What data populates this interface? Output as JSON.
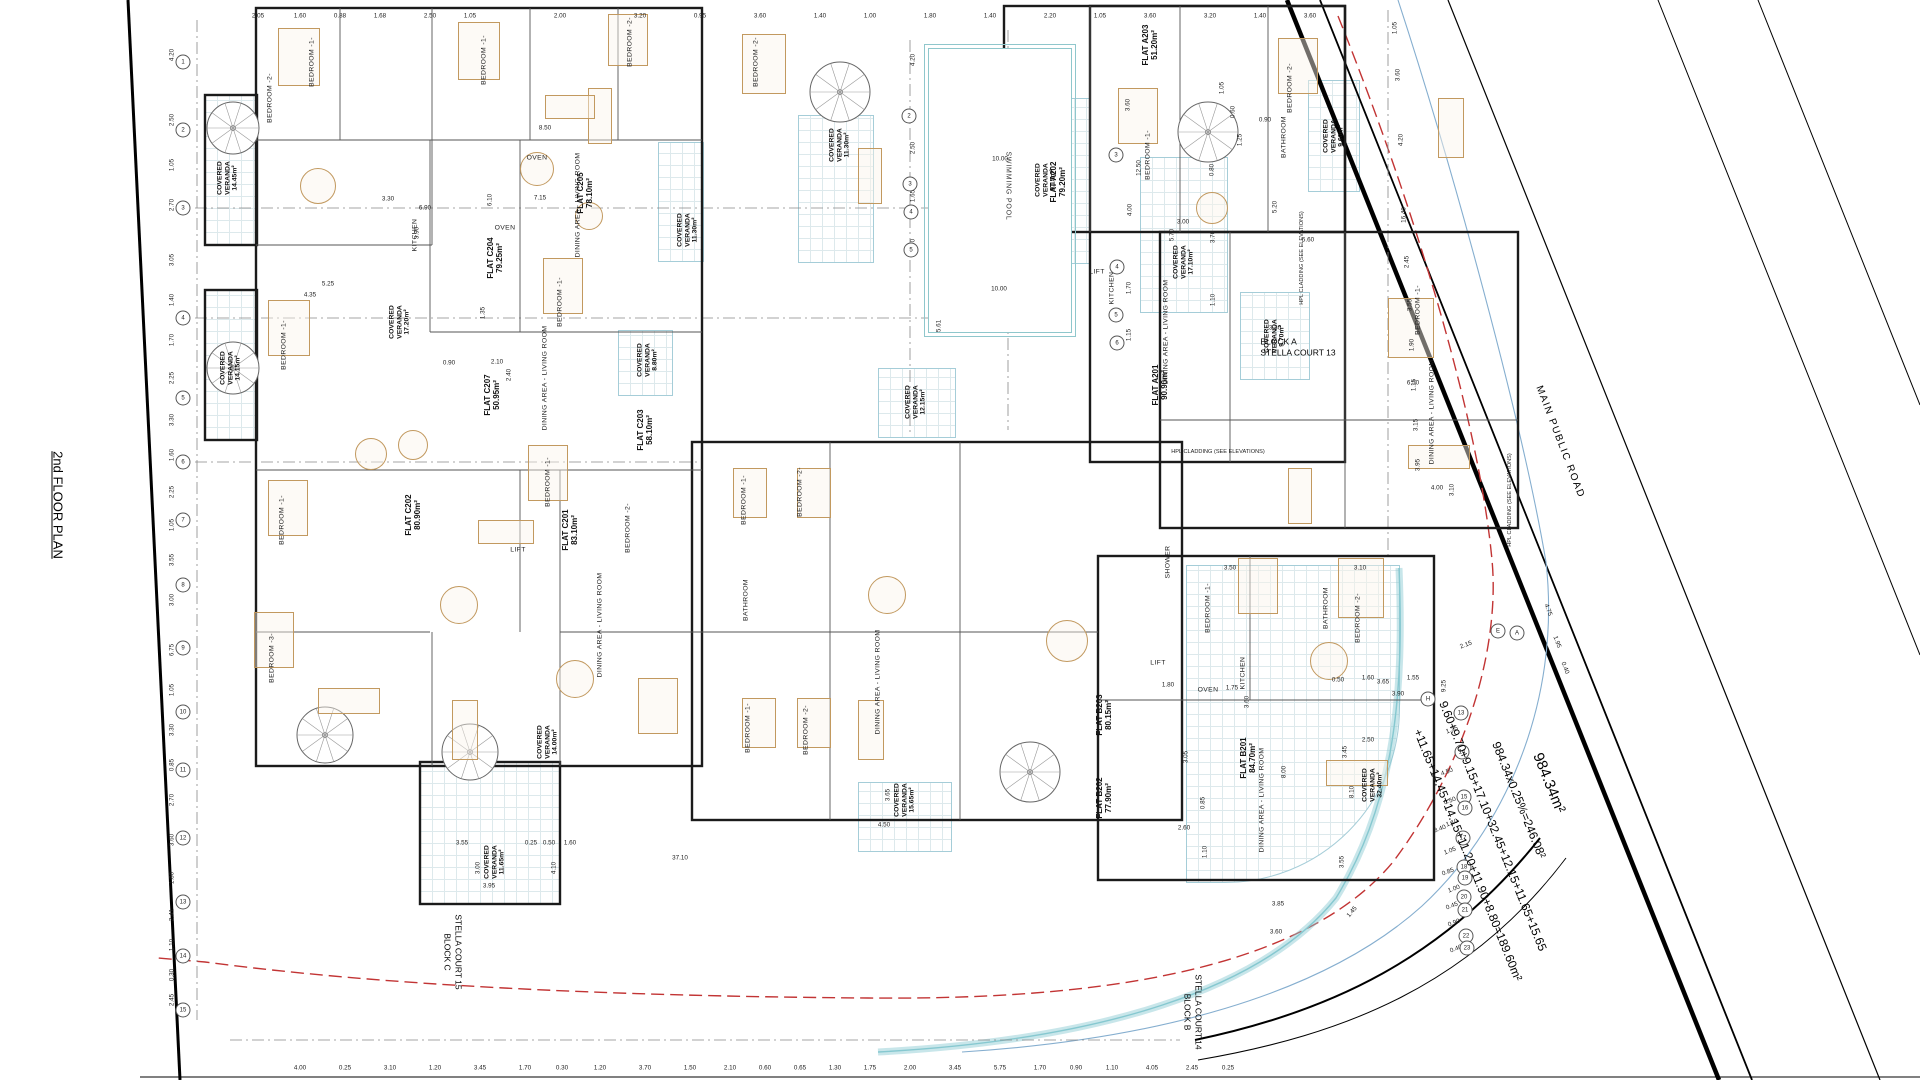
{
  "drawing": {
    "title": "2nd FLOOR PLAN",
    "road": "MAIN PUBLIC ROAD",
    "veranda_title": "COVERED VERANDA",
    "cladding": "HPL CLADDING (SEE ELEVATIONS)",
    "pool": {
      "label": "SWIMMING POOL",
      "w": "10.00",
      "w2": "10.00",
      "side": "5.61"
    },
    "blocks": {
      "a": {
        "name": "BLOCK A",
        "court": "STELLA COURT 13"
      },
      "b": {
        "name": "BLOCK B",
        "court": "STELLA COURT 14"
      },
      "c": {
        "name": "BLOCK C",
        "court": "STELLA COURT 15"
      }
    },
    "calc": {
      "total_area": "984.34m²",
      "coverage": "984.34x0.25%=246.08²",
      "sum_line1": "9.60+9.70+9.15+17.10+32.45+12.15+11.65+15.65",
      "sum_line2": "+11.65+14.45+14.15+11.20+11.90+8.80=189.60m²"
    },
    "colors": {
      "wall": "#1b1b1b",
      "veranda": "#a5cdd8",
      "red_boundary": "#c23434",
      "blue_curb": "#85aecf",
      "teal_band": "#86c8d0",
      "furniture": "#c2995f"
    }
  },
  "flats": [
    [
      "FLAT C205",
      "78.10m²",
      585,
      193
    ],
    [
      "FLAT C204",
      "79.25m²",
      495,
      258
    ],
    [
      "FLAT C207",
      "50.95m²",
      492,
      395
    ],
    [
      "FLAT C203",
      "58.10m²",
      645,
      430
    ],
    [
      "FLAT C202",
      "80.90m²",
      413,
      515
    ],
    [
      "FLAT C201",
      "83.10m²",
      570,
      530
    ],
    [
      "FLAT A203",
      "51.20m²",
      1150,
      45
    ],
    [
      "FLAT A202",
      "79.20m²",
      1058,
      182
    ],
    [
      "FLAT A201",
      "90.90m²",
      1160,
      385
    ],
    [
      "FLAT B203",
      "80.15m²",
      1104,
      715
    ],
    [
      "FLAT B202",
      "77.90m²",
      1104,
      798
    ],
    [
      "FLAT B201",
      "84.70m²",
      1248,
      758
    ]
  ],
  "verandas": [
    [
      "14.45m²",
      228,
      178
    ],
    [
      "17.20m²",
      400,
      322
    ],
    [
      "11.30m²",
      688,
      230
    ],
    [
      "11.30m²",
      840,
      145
    ],
    [
      "8.80m²",
      648,
      360
    ],
    [
      "14.15m²",
      231,
      368
    ],
    [
      "11.65m²",
      495,
      862
    ],
    [
      "14.00m²",
      548,
      742
    ],
    [
      "12.15m²",
      916,
      402
    ],
    [
      "9.15m²",
      1046,
      180
    ],
    [
      "17.10m²",
      1184,
      262
    ],
    [
      "9.60m²",
      1334,
      136
    ],
    [
      "9.70m²",
      1275,
      336
    ],
    [
      "32.40m²",
      1373,
      785
    ],
    [
      "15.65m²",
      905,
      800
    ]
  ],
  "rooms": [
    [
      "BEDROOM -1-",
      312,
      62,
      -90
    ],
    [
      "BEDROOM -2-",
      270,
      98,
      -90
    ],
    [
      "BEDROOM -1-",
      484,
      60,
      -90
    ],
    [
      "BEDROOM -2-",
      630,
      42,
      -90
    ],
    [
      "BEDROOM -2-",
      756,
      62,
      -90
    ],
    [
      "BEDROOM -1-",
      284,
      345,
      -90
    ],
    [
      "BEDROOM -1-",
      560,
      302,
      -90
    ],
    [
      "BEDROOM -1-",
      282,
      520,
      -90
    ],
    [
      "BEDROOM -1-",
      548,
      482,
      -90
    ],
    [
      "BEDROOM -2-",
      628,
      528,
      -90
    ],
    [
      "BEDROOM -3-",
      272,
      658,
      -90
    ],
    [
      "BEDROOM -1-",
      744,
      500,
      -90
    ],
    [
      "BEDROOM -2-",
      800,
      492,
      -90
    ],
    [
      "BEDROOM -1-",
      748,
      728,
      -90
    ],
    [
      "BEDROOM -2-",
      806,
      730,
      -90
    ],
    [
      "BEDROOM -1-",
      1148,
      155,
      -90
    ],
    [
      "BEDROOM -2-",
      1290,
      88,
      -90
    ],
    [
      "BEDROOM -1-",
      1418,
      310,
      -90
    ],
    [
      "BEDROOM -1-",
      1208,
      608,
      -90
    ],
    [
      "BEDROOM -2-",
      1358,
      618,
      -90
    ],
    [
      "BATHROOM",
      1284,
      137,
      -90
    ],
    [
      "BATHROOM",
      1326,
      608,
      -90
    ],
    [
      "BATHROOM",
      746,
      600,
      -90
    ],
    [
      "SHOWER",
      1168,
      562,
      -90
    ],
    [
      "KITCHEN",
      415,
      235,
      -90
    ],
    [
      "KITCHEN",
      1112,
      288,
      -90
    ],
    [
      "KITCHEN",
      1243,
      673,
      -90
    ],
    [
      "OVEN",
      537,
      158,
      0
    ],
    [
      "OVEN",
      505,
      228,
      0
    ],
    [
      "OVEN",
      1208,
      690,
      0
    ],
    [
      "LIFT",
      518,
      550,
      0
    ],
    [
      "LIFT",
      1097,
      272,
      0
    ],
    [
      "LIFT",
      1158,
      663,
      0
    ],
    [
      "DINING AREA - LIVING ROOM",
      578,
      205,
      -90
    ],
    [
      "DINING AREA - LIVING ROOM",
      545,
      378,
      -90
    ],
    [
      "DINING AREA - LIVING ROOM",
      1166,
      332,
      -90
    ],
    [
      "DINING AREA - LIVING ROOM",
      1432,
      412,
      -90
    ],
    [
      "DINING AREA - LIVING ROOM",
      1262,
      800,
      -90
    ],
    [
      "DINING AREA - LIVING ROOM",
      878,
      682,
      -90
    ],
    [
      "DINING AREA - LIVING ROOM",
      600,
      625,
      -90
    ]
  ],
  "dims": [
    [
      "4.20",
      172,
      55,
      -90
    ],
    [
      "2.50",
      172,
      120,
      -90
    ],
    [
      "1.05",
      172,
      165,
      -90
    ],
    [
      "2.70",
      172,
      205,
      -90
    ],
    [
      "3.05",
      172,
      260,
      -90
    ],
    [
      "1.40",
      172,
      300,
      -90
    ],
    [
      "1.70",
      172,
      340,
      -90
    ],
    [
      "2.25",
      172,
      378,
      -90
    ],
    [
      "3.30",
      172,
      420,
      -90
    ],
    [
      "1.60",
      172,
      455,
      -90
    ],
    [
      "2.25",
      172,
      492,
      -90
    ],
    [
      "1.05",
      172,
      525,
      -90
    ],
    [
      "3.55",
      172,
      560,
      -90
    ],
    [
      "3.00",
      172,
      600,
      -90
    ],
    [
      "6.75",
      172,
      650,
      -90
    ],
    [
      "1.05",
      172,
      690,
      -90
    ],
    [
      "3.30",
      172,
      730,
      -90
    ],
    [
      "0.85",
      172,
      765,
      -90
    ],
    [
      "2.70",
      172,
      800,
      -90
    ],
    [
      "3.60",
      172,
      840,
      -90
    ],
    [
      "1.80",
      172,
      878,
      -90
    ],
    [
      "2.41",
      172,
      915,
      -90
    ],
    [
      "1.10",
      172,
      945,
      -90
    ],
    [
      "0.30",
      172,
      975,
      -90
    ],
    [
      "2.45",
      172,
      1000,
      -90
    ],
    [
      "2.05",
      258,
      16,
      0
    ],
    [
      "1.60",
      300,
      16,
      0
    ],
    [
      "0.88",
      340,
      16,
      0
    ],
    [
      "1.68",
      380,
      16,
      0
    ],
    [
      "2.50",
      430,
      16,
      0
    ],
    [
      "1.05",
      470,
      16,
      0
    ],
    [
      "2.00",
      560,
      16,
      0
    ],
    [
      "3.20",
      640,
      16,
      0
    ],
    [
      "0.95",
      700,
      16,
      0
    ],
    [
      "3.60",
      760,
      16,
      0
    ],
    [
      "1.40",
      820,
      16,
      0
    ],
    [
      "1.00",
      870,
      16,
      0
    ],
    [
      "1.80",
      930,
      16,
      0
    ],
    [
      "1.40",
      990,
      16,
      0
    ],
    [
      "2.20",
      1050,
      16,
      0
    ],
    [
      "1.05",
      1100,
      16,
      0
    ],
    [
      "3.60",
      1150,
      16,
      0
    ],
    [
      "3.20",
      1210,
      16,
      0
    ],
    [
      "1.40",
      1260,
      16,
      0
    ],
    [
      "3.60",
      1310,
      16,
      0
    ],
    [
      "1.05",
      1395,
      28,
      -90
    ],
    [
      "3.60",
      1398,
      75,
      -90
    ],
    [
      "4.20",
      1401,
      140,
      -90
    ],
    [
      "16.40",
      1404,
      215,
      -90
    ],
    [
      "2.45",
      1407,
      262,
      -90
    ],
    [
      "3.55",
      1410,
      305,
      -90
    ],
    [
      "1.90",
      1412,
      345,
      -90
    ],
    [
      "1.15",
      1414,
      385,
      -90
    ],
    [
      "3.15",
      1416,
      425,
      -90
    ],
    [
      "3.95",
      1418,
      465,
      -90
    ],
    [
      "4.00",
      300,
      1068,
      0
    ],
    [
      "0.25",
      345,
      1068,
      0
    ],
    [
      "3.10",
      390,
      1068,
      0
    ],
    [
      "1.20",
      435,
      1068,
      0
    ],
    [
      "3.45",
      480,
      1068,
      0
    ],
    [
      "1.70",
      525,
      1068,
      0
    ],
    [
      "0.30",
      562,
      1068,
      0
    ],
    [
      "1.20",
      600,
      1068,
      0
    ],
    [
      "3.70",
      645,
      1068,
      0
    ],
    [
      "1.50",
      690,
      1068,
      0
    ],
    [
      "2.10",
      730,
      1068,
      0
    ],
    [
      "0.60",
      765,
      1068,
      0
    ],
    [
      "0.65",
      800,
      1068,
      0
    ],
    [
      "1.30",
      835,
      1068,
      0
    ],
    [
      "1.75",
      870,
      1068,
      0
    ],
    [
      "2.00",
      910,
      1068,
      0
    ],
    [
      "3.45",
      955,
      1068,
      0
    ],
    [
      "5.75",
      1000,
      1068,
      0
    ],
    [
      "1.70",
      1040,
      1068,
      0
    ],
    [
      "0.90",
      1076,
      1068,
      0
    ],
    [
      "1.10",
      1112,
      1068,
      0
    ],
    [
      "4.05",
      1152,
      1068,
      0
    ],
    [
      "2.45",
      1192,
      1068,
      0
    ],
    [
      "0.25",
      1228,
      1068,
      0
    ],
    [
      "37.10",
      680,
      858,
      0
    ],
    [
      "3.65",
      888,
      795,
      -90
    ],
    [
      "4.50",
      884,
      825,
      0
    ],
    [
      "4.20",
      913,
      60,
      -90
    ],
    [
      "2.50",
      913,
      148,
      -90
    ],
    [
      "1.65",
      913,
      196,
      -90
    ],
    [
      "2.70",
      913,
      245,
      -90
    ],
    [
      "6.90",
      425,
      208,
      0
    ],
    [
      "6.10",
      490,
      200,
      -90
    ],
    [
      "3.90",
      417,
      233,
      -90
    ],
    [
      "3.30",
      388,
      199,
      0
    ],
    [
      "8.50",
      545,
      128,
      0
    ],
    [
      "7.15",
      540,
      198,
      0
    ],
    [
      "4.35",
      310,
      295,
      0
    ],
    [
      "5.25",
      328,
      284,
      0
    ],
    [
      "3.60",
      1128,
      105,
      -90
    ],
    [
      "12.50",
      1139,
      168,
      -90
    ],
    [
      "4.00",
      1130,
      210,
      -90
    ],
    [
      "1.70",
      1129,
      288,
      -90
    ],
    [
      "1.15",
      1129,
      335,
      -90
    ],
    [
      "5.70",
      1172,
      235,
      -90
    ],
    [
      "3.00",
      1183,
      222,
      0
    ],
    [
      "3.70",
      1213,
      237,
      -90
    ],
    [
      "1.10",
      1213,
      300,
      -90
    ],
    [
      "0.80",
      1212,
      170,
      -90
    ],
    [
      "5.20",
      1275,
      207,
      -90
    ],
    [
      "5.60",
      1308,
      240,
      0
    ],
    [
      "3.30",
      1275,
      328,
      0
    ],
    [
      "0.90",
      1265,
      120,
      0
    ],
    [
      "1.05",
      1222,
      88,
      -90
    ],
    [
      "0.60",
      1233,
      112,
      -90
    ],
    [
      "1.25",
      1240,
      140,
      -90
    ],
    [
      "3.50",
      1230,
      568,
      0
    ],
    [
      "3.10",
      1360,
      568,
      0
    ],
    [
      "6.50",
      1413,
      383,
      0
    ],
    [
      "4.00",
      1437,
      488,
      0
    ],
    [
      "3.10",
      1452,
      490,
      -90
    ],
    [
      "3.65",
      1383,
      682,
      0
    ],
    [
      "3.90",
      1398,
      694,
      0
    ],
    [
      "1.60",
      1368,
      678,
      0
    ],
    [
      "1.55",
      1413,
      678,
      0
    ],
    [
      "0.50",
      1338,
      680,
      0
    ],
    [
      "9.25",
      1444,
      686,
      -90
    ],
    [
      "2.50",
      1368,
      740,
      0
    ],
    [
      "3.45",
      1345,
      752,
      -90
    ],
    [
      "8.10",
      1352,
      792,
      -90
    ],
    [
      "3.55",
      1342,
      862,
      -90
    ],
    [
      "1.75",
      1232,
      688,
      0
    ],
    [
      "3.60",
      1247,
      702,
      -90
    ],
    [
      "8.00",
      1284,
      772,
      -90
    ],
    [
      "1.80",
      1168,
      685,
      0
    ],
    [
      "3.05",
      1186,
      757,
      -90
    ],
    [
      "0.85",
      1203,
      803,
      -90
    ],
    [
      "2.60",
      1184,
      828,
      0
    ],
    [
      "1.10",
      1205,
      852,
      -90
    ],
    [
      "3.85",
      1278,
      904,
      0
    ],
    [
      "3.60",
      1276,
      932,
      0
    ],
    [
      "1.45",
      1352,
      912,
      -50
    ],
    [
      "2.10",
      497,
      362,
      0
    ],
    [
      "2.40",
      509,
      375,
      -90
    ],
    [
      "0.90",
      449,
      363,
      0
    ],
    [
      "1.35",
      483,
      313,
      -90
    ],
    [
      "3.55",
      462,
      843,
      0
    ],
    [
      "3.00",
      478,
      868,
      -90
    ],
    [
      "3.95",
      489,
      886,
      0
    ],
    [
      "0.25",
      531,
      843,
      0
    ],
    [
      "0.50",
      549,
      843,
      0
    ],
    [
      "4.10",
      554,
      868,
      -90
    ],
    [
      "1.60",
      570,
      843,
      0
    ],
    [
      "4.75",
      1548,
      610,
      69
    ],
    [
      "1.95",
      1557,
      642,
      69
    ],
    [
      "0.40",
      1565,
      668,
      69
    ],
    [
      "2.15",
      1466,
      645,
      -21
    ],
    [
      "1.35",
      1452,
      730,
      -21
    ],
    [
      "4.50",
      1447,
      772,
      -21
    ],
    [
      "0.50",
      1450,
      801,
      -21
    ],
    [
      "1.10",
      1452,
      823,
      -21
    ],
    [
      "8.40",
      1440,
      829,
      -21
    ],
    [
      "1.05",
      1450,
      851,
      -21
    ],
    [
      "0.85",
      1448,
      872,
      -21
    ],
    [
      "1.00",
      1454,
      889,
      -21
    ],
    [
      "0.45",
      1452,
      906,
      -21
    ],
    [
      "0.90",
      1454,
      923,
      -21
    ],
    [
      "0.40",
      1456,
      949,
      -21
    ]
  ],
  "bubbles": [
    [
      "1",
      183,
      62
    ],
    [
      "2",
      183,
      130
    ],
    [
      "3",
      183,
      208
    ],
    [
      "4",
      183,
      318
    ],
    [
      "5",
      183,
      398
    ],
    [
      "6",
      183,
      462
    ],
    [
      "7",
      183,
      520
    ],
    [
      "8",
      183,
      585
    ],
    [
      "9",
      183,
      648
    ],
    [
      "10",
      183,
      712
    ],
    [
      "11",
      183,
      770
    ],
    [
      "12",
      183,
      838
    ],
    [
      "13",
      183,
      902
    ],
    [
      "14",
      183,
      956
    ],
    [
      "15",
      183,
      1010
    ],
    [
      "2",
      909,
      116
    ],
    [
      "3",
      910,
      184
    ],
    [
      "4",
      911,
      212
    ],
    [
      "5",
      911,
      250
    ],
    [
      "3",
      1116,
      155
    ],
    [
      "4",
      1117,
      267
    ],
    [
      "5",
      1116,
      315
    ],
    [
      "6",
      1117,
      343
    ],
    [
      "13",
      1461,
      713
    ],
    [
      "14",
      1462,
      752
    ],
    [
      "15",
      1464,
      797
    ],
    [
      "16",
      1465,
      808
    ],
    [
      "17",
      1463,
      838
    ],
    [
      "18",
      1464,
      867
    ],
    [
      "19",
      1465,
      878
    ],
    [
      "20",
      1464,
      897
    ],
    [
      "21",
      1465,
      910
    ],
    [
      "22",
      1466,
      936
    ],
    [
      "23",
      1467,
      948
    ],
    [
      "E",
      1498,
      631
    ],
    [
      "A",
      1517,
      633
    ],
    [
      "H",
      1428,
      699
    ]
  ]
}
